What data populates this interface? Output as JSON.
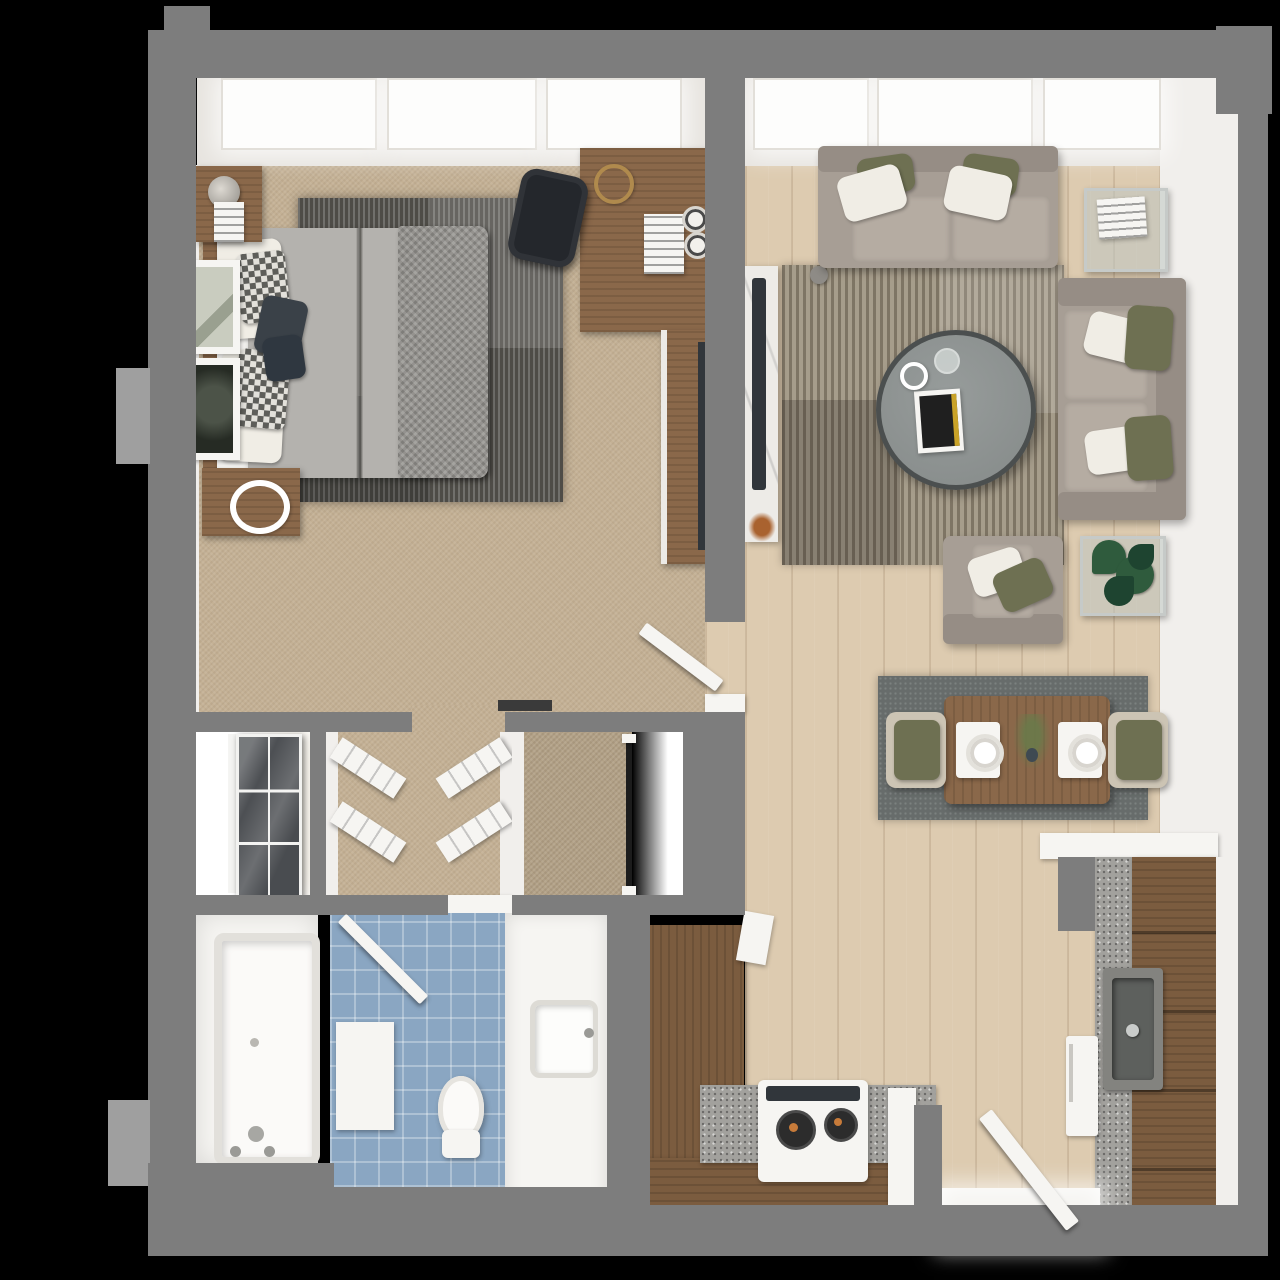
{
  "scene": {
    "type": "3d-floor-plan-render",
    "description": "Top-down 3D apartment floor plan, one bedroom one bath",
    "width_px": 1280,
    "height_px": 1280
  },
  "palette": {
    "bg": "#000000",
    "wall": "#7d7d7d",
    "wall-light": "#9f9f9f",
    "wall-face": "#f1efec",
    "window-band": "#e7e4df",
    "window-pane": "#fdfdfc",
    "carpet": "#c4b195",
    "carpet-dark": "#b3a288",
    "wood-floor": "#ddcbb0",
    "wood-dark": "#7b5c3f",
    "wood-mid": "#8a684a",
    "granite": "#a2a19d",
    "marble": "#edebe7",
    "tv": "#31363b",
    "sofa": "#a79e95",
    "sofa-dark": "#968d85",
    "sofa-cushion": "#b5aca2",
    "pillow-white": "#f0ede5",
    "pillow-olive": "#6e7052",
    "pillow-navy": "#3a4148",
    "bed-duvet": "#b4b2ae",
    "bed-throw": "#94928e",
    "rug-dining": "#676c6b",
    "tile-blue": "#8aa6c2",
    "white": "#f6f5f2",
    "wardrobe": "#43464a",
    "chrome": "#c6cac8",
    "glass": "#bec6c2",
    "plant": "#2f5b3d",
    "plant-dark": "#1e4430",
    "chair-black": "#24272c",
    "accent-rust": "#a9622f",
    "magazine-gold": "#c9a227"
  },
  "rooms": {
    "bedroom": {
      "label": "Bedroom"
    },
    "living": {
      "label": "Living / Dining Room"
    },
    "kitchen": {
      "label": "Kitchen"
    },
    "bathroom": {
      "label": "Bathroom"
    },
    "tubroom": {
      "label": "Bathtub Room"
    },
    "closets": {
      "label": "Closets / Dressing Hall"
    },
    "entry": {
      "label": "Entry"
    }
  },
  "furniture": {
    "bedroom": [
      "queen-bed",
      "knit-throw",
      "checkered-pillows",
      "nightstand-top",
      "nightstand-bottom",
      "table-lamp",
      "framed-art-1",
      "framed-art-2",
      "area-rug",
      "desk",
      "desk-chair",
      "desk-lamp",
      "tv-console",
      "tv"
    ],
    "living": [
      "sofa-top",
      "sofa-right",
      "armchair",
      "round-coffee-table",
      "magazine",
      "side-table-glass",
      "plant-side-table",
      "monstera-plant",
      "tv-marble-console",
      "tv",
      "striped-area-rug",
      "floor-lamp"
    ],
    "dining": [
      "dining-table",
      "dining-chair-left",
      "dining-chair-right",
      "placemats",
      "plates",
      "centerpiece",
      "dining-rug"
    ],
    "kitchen": [
      "l-counter",
      "range-stove",
      "sink",
      "fridge",
      "tall-cabinets",
      "granite-counters",
      "peninsula-counter"
    ],
    "bathroom": [
      "bathtub",
      "shower-door",
      "toilet",
      "vanity-sink",
      "tile-floor",
      "bench"
    ],
    "closets": [
      "mirrored-wardrobe",
      "shoe-shelves",
      "hanging-rod"
    ],
    "doors": [
      "bedroom-door-open",
      "entry-door-open"
    ]
  },
  "windows": {
    "bedroom_panes": 3,
    "living_panes": 3
  }
}
